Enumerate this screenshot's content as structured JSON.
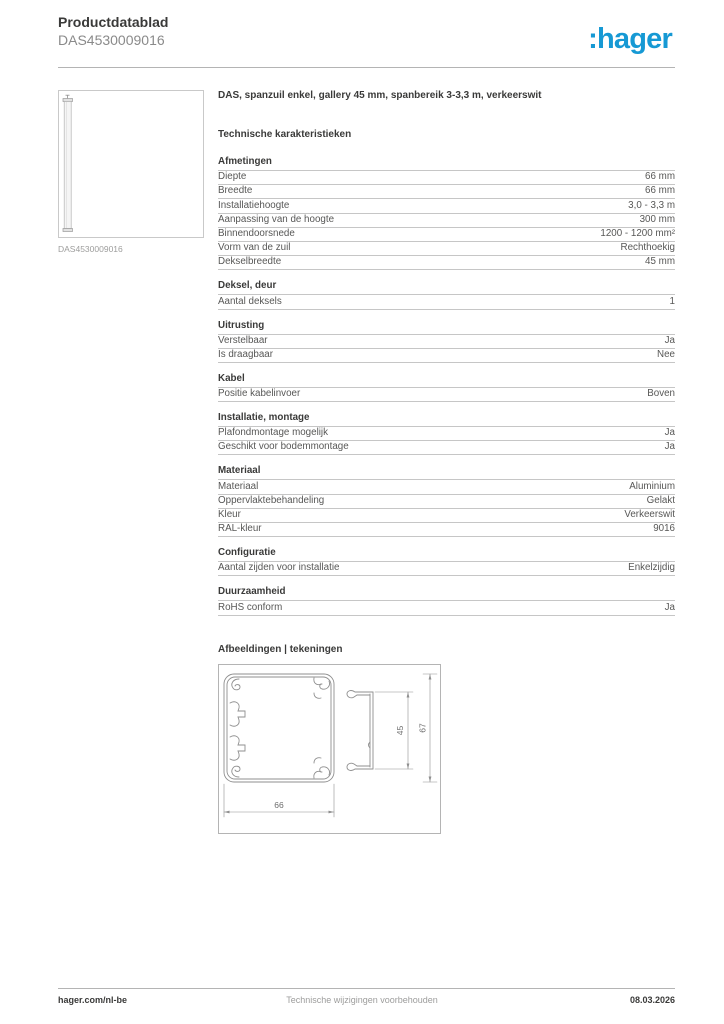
{
  "header": {
    "title": "Productdatablad",
    "subtitle": "DAS4530009016",
    "logo_text": ":hager",
    "logo_color": "#1699d4"
  },
  "product": {
    "description": "DAS, spanzuil enkel, gallery 45 mm, spanbereik 3-3,3 m, verkeerswit",
    "image_caption": "DAS4530009016"
  },
  "tech_title": "Technische karakteristieken",
  "sections": [
    {
      "heading": "Afmetingen",
      "rows": [
        {
          "label": "Diepte",
          "value": "66 mm"
        },
        {
          "label": "Breedte",
          "value": "66 mm"
        },
        {
          "label": "Installatiehoogte",
          "value": "3,0 - 3,3 m"
        },
        {
          "label": "Aanpassing van de hoogte",
          "value": "300 mm"
        },
        {
          "label": "Binnendoorsnede",
          "value": "1200 - 1200 mm²"
        },
        {
          "label": "Vorm van de zuil",
          "value": "Rechthoekig"
        },
        {
          "label": "Dekselbreedte",
          "value": "45 mm"
        }
      ]
    },
    {
      "heading": "Deksel, deur",
      "rows": [
        {
          "label": "Aantal deksels",
          "value": "1"
        }
      ]
    },
    {
      "heading": "Uitrusting",
      "rows": [
        {
          "label": "Verstelbaar",
          "value": "Ja"
        },
        {
          "label": "Is draagbaar",
          "value": "Nee"
        }
      ]
    },
    {
      "heading": "Kabel",
      "rows": [
        {
          "label": "Positie kabelinvoer",
          "value": "Boven"
        }
      ]
    },
    {
      "heading": "Installatie, montage",
      "rows": [
        {
          "label": "Plafondmontage mogelijk",
          "value": "Ja"
        },
        {
          "label": "Geschikt voor bodemmontage",
          "value": "Ja"
        }
      ]
    },
    {
      "heading": "Materiaal",
      "rows": [
        {
          "label": "Materiaal",
          "value": "Aluminium"
        },
        {
          "label": "Oppervlaktebehandeling",
          "value": "Gelakt"
        },
        {
          "label": "Kleur",
          "value": "Verkeerswit"
        },
        {
          "label": "RAL-kleur",
          "value": "9016"
        }
      ]
    },
    {
      "heading": "Configuratie",
      "rows": [
        {
          "label": "Aantal zijden voor installatie",
          "value": "Enkelzijdig"
        }
      ]
    },
    {
      "heading": "Duurzaamheid",
      "rows": [
        {
          "label": "RoHS conform",
          "value": "Ja"
        }
      ]
    }
  ],
  "drawings": {
    "title": "Afbeeldingen | tekeningen",
    "dims": {
      "width_mm": "66",
      "cover_mm": "45",
      "height_mm": "67"
    }
  },
  "footer": {
    "site": "hager.com/nl-be",
    "notice": "Technische wijzigingen voorbehouden",
    "date": "08.03.2026"
  }
}
